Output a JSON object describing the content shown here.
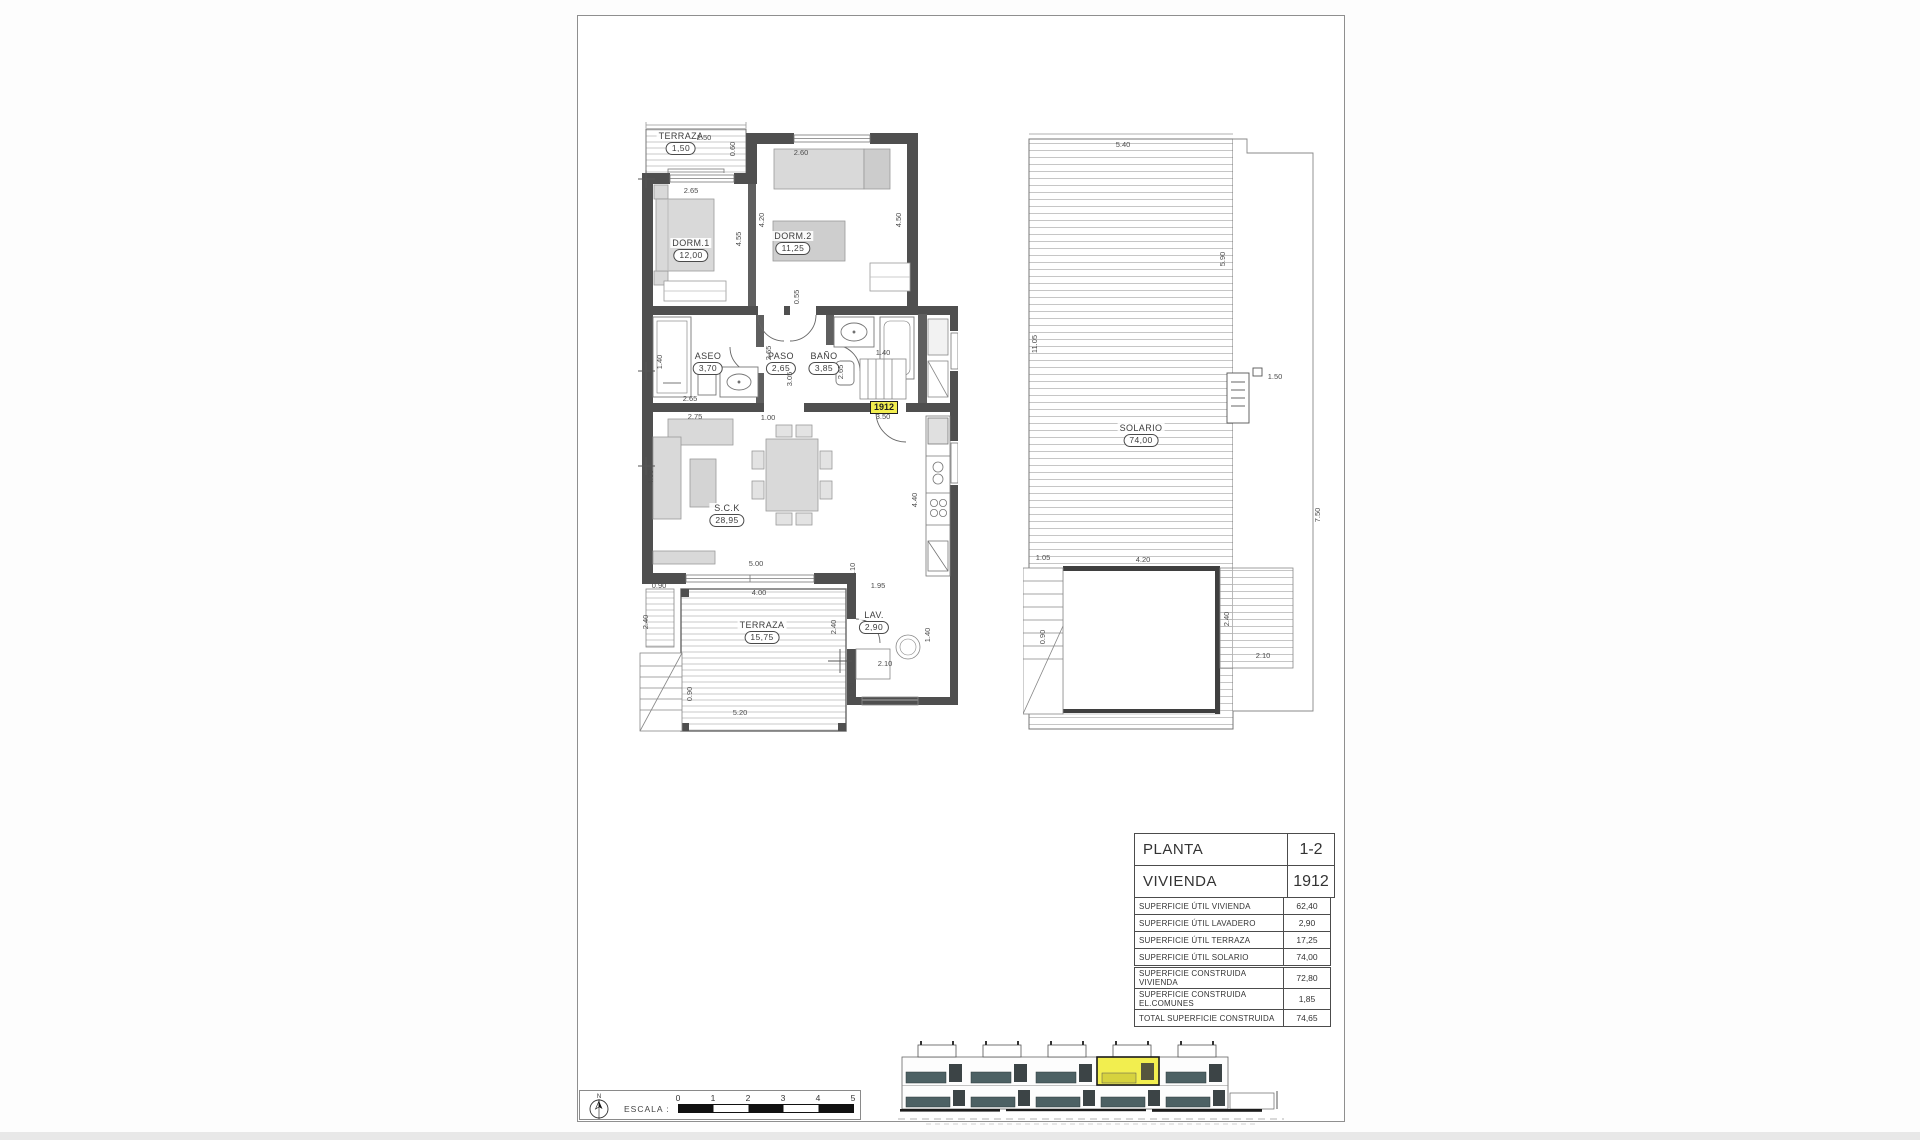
{
  "floor_plan": {
    "unit_tag": "1912",
    "rooms": {
      "terraza_top": {
        "name": "TERRAZA",
        "area": "1,50"
      },
      "dorm1": {
        "name": "DORM.1",
        "area": "12,00"
      },
      "dorm2": {
        "name": "DORM.2",
        "area": "11,25"
      },
      "aseo": {
        "name": "ASEO",
        "area": "3,70"
      },
      "paso": {
        "name": "PASO",
        "area": "2,65"
      },
      "bano": {
        "name": "BAÑO",
        "area": "3,85"
      },
      "sck": {
        "name": "S.C.K",
        "area": "28,95"
      },
      "terraza_main": {
        "name": "TERRAZA",
        "area": "15,75"
      },
      "lavadero": {
        "name": "LAV.",
        "area": "2,90"
      }
    },
    "dims": [
      "2.50",
      "0.60",
      "2.65",
      "2.60",
      "4.55",
      "4.20",
      "4.50",
      "0.55",
      "1.40",
      "2.65",
      "2.75",
      "2.65",
      "3.05",
      "2.65",
      "1.00",
      "1.40",
      "3.50",
      "4.00",
      "4.40",
      "5.00",
      "4.00",
      "1.10",
      "1.95",
      "0.90",
      "2.40",
      "2.40",
      "1.20",
      "5.20",
      "0.90",
      "2.10",
      "1.40"
    ]
  },
  "solarium_plan": {
    "room": {
      "name": "SOLARIO",
      "area": "74,00"
    },
    "dims": [
      "5.40",
      "5.90",
      "11.05",
      "1.50",
      "7.50",
      "1.05",
      "4.20",
      "0.90",
      "2.40",
      "2.10"
    ]
  },
  "tables": {
    "title": {
      "rows": [
        {
          "label": "PLANTA",
          "value": "1-2"
        },
        {
          "label": "VIVIENDA",
          "value": "1912"
        }
      ]
    },
    "util": {
      "rows": [
        {
          "label": "SUPERFICIE ÚTIL VIVIENDA",
          "value": "62,40"
        },
        {
          "label": "SUPERFICIE ÚTIL LAVADERO",
          "value": "2,90"
        },
        {
          "label": "SUPERFICIE ÚTIL TERRAZA",
          "value": "17,25"
        },
        {
          "label": "SUPERFICIE ÚTIL SOLARIO",
          "value": "74,00"
        }
      ]
    },
    "built": {
      "rows": [
        {
          "label": "SUPERFICIE CONSTRUIDA VIVIENDA",
          "value": "72,80"
        },
        {
          "label": "SUPERFICIE CONSTRUIDA EL.COMUNES",
          "value": "1,85"
        },
        {
          "label": "TOTAL SUPERFICIE CONSTRUIDA",
          "value": "74,65"
        }
      ]
    }
  },
  "scale_bar": {
    "label": "ESCALA :",
    "north": "N",
    "ticks": [
      "0",
      "1",
      "2",
      "3",
      "4",
      "5"
    ]
  },
  "colors": {
    "highlight": "#f2ee4f",
    "wall": "#4f4f4f",
    "balcony": "#4d6164",
    "furniture": "#d9d9d9"
  }
}
